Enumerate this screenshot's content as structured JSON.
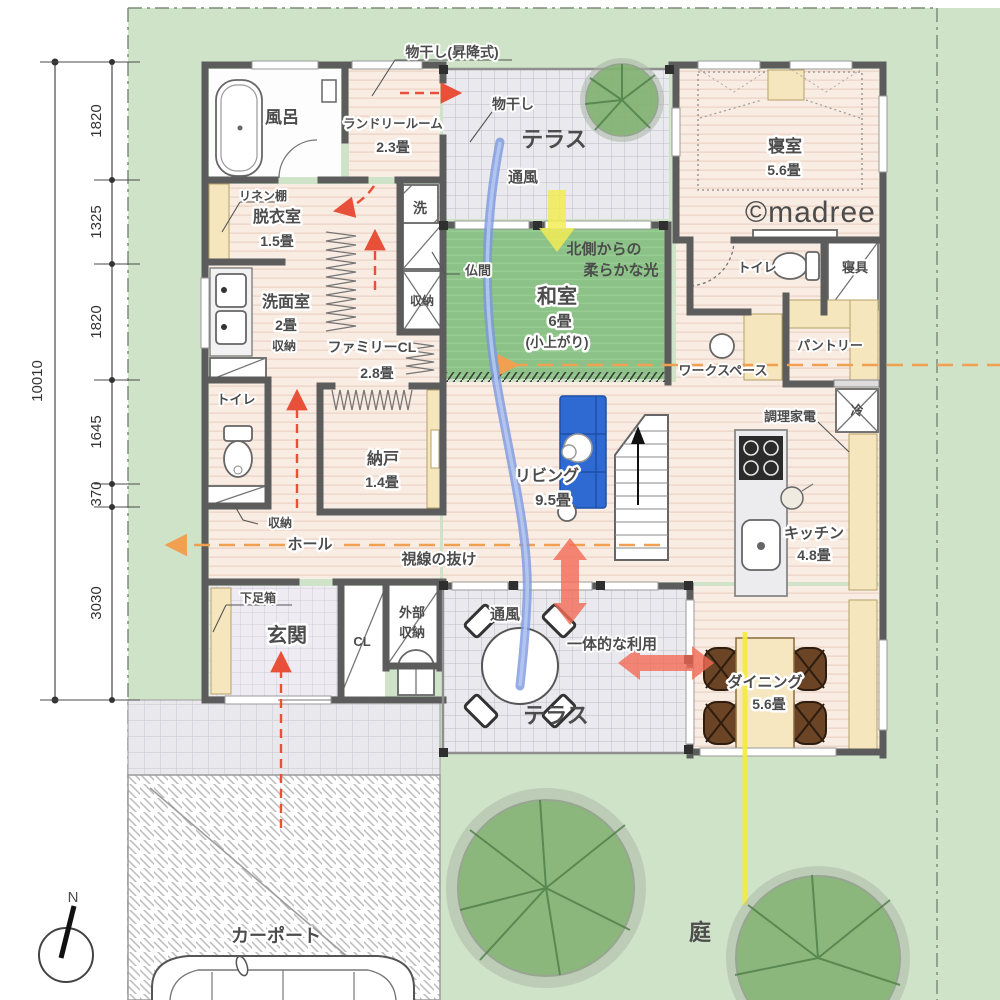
{
  "site": {
    "garden": "庭",
    "carport": "カーポート",
    "compass": "N",
    "watermark": "©madree"
  },
  "dimensions": {
    "total": "10010",
    "segments": [
      "1820",
      "1325",
      "1820",
      "1645",
      "370",
      "3030"
    ]
  },
  "rooms": {
    "bath": {
      "name": "風呂"
    },
    "laundry": {
      "name": "ランドリールーム",
      "size": "2.3畳"
    },
    "terrace_north": {
      "name": "テラス"
    },
    "bedroom": {
      "name": "寝室",
      "size": "5.6畳"
    },
    "dressing": {
      "name": "脱衣室",
      "size": "1.5畳"
    },
    "washroom": {
      "name": "洗面室",
      "size": "2畳"
    },
    "family_closet": {
      "name": "ファミリーCL",
      "size": "2.8畳"
    },
    "japanese_room": {
      "name": "和室",
      "size": "6畳",
      "note": "(小上がり)"
    },
    "storeroom": {
      "name": "納戸",
      "size": "1.4畳"
    },
    "toilet_hall": {
      "name": "トイレ"
    },
    "toilet_bedroom": {
      "name": "トイレ"
    },
    "bedding_closet": {
      "name": "寝具"
    },
    "pantry": {
      "name": "パントリー"
    },
    "workspace": {
      "name": "ワークスペース"
    },
    "living": {
      "name": "リビング",
      "size": "9.5畳"
    },
    "kitchen": {
      "name": "キッチン",
      "size": "4.8畳"
    },
    "dining": {
      "name": "ダイニング",
      "size": "5.6畳"
    },
    "entrance": {
      "name": "玄関"
    },
    "closet": {
      "name": "CL"
    },
    "exterior_storage": {
      "line1": "外部",
      "line2": "収納"
    },
    "terrace_south": {
      "name": "テラス"
    },
    "hall": {
      "name": "ホール"
    }
  },
  "fixtures": {
    "washer": "洗",
    "fridge": "冷",
    "buddhist_alcove": "仏間",
    "linen_shelf": "リネン棚",
    "shoe_box": "下足箱",
    "storage": "収納"
  },
  "annotations": {
    "laundry_pole_lift": "物干し(昇降式)",
    "laundry_pole": "物干し",
    "airflow_north": "通風",
    "airflow_south": "通風",
    "north_light_line1": "北側からの",
    "north_light_line2": "柔らかな光",
    "sightline": "視線の抜け",
    "integrated_use": "一体的な利用",
    "cooking_appliances": "調理家電"
  },
  "colors": {
    "lawn": "#cfe3c8",
    "tatami": "#8cc287",
    "wood_floor": "#f8ece3",
    "accent_red": "#f26a55",
    "accent_yellow": "#f2ec55",
    "flow_blue": "#7b97e0",
    "sight_orange": "#f0a050",
    "north_light_text": "#ccdf3e"
  }
}
